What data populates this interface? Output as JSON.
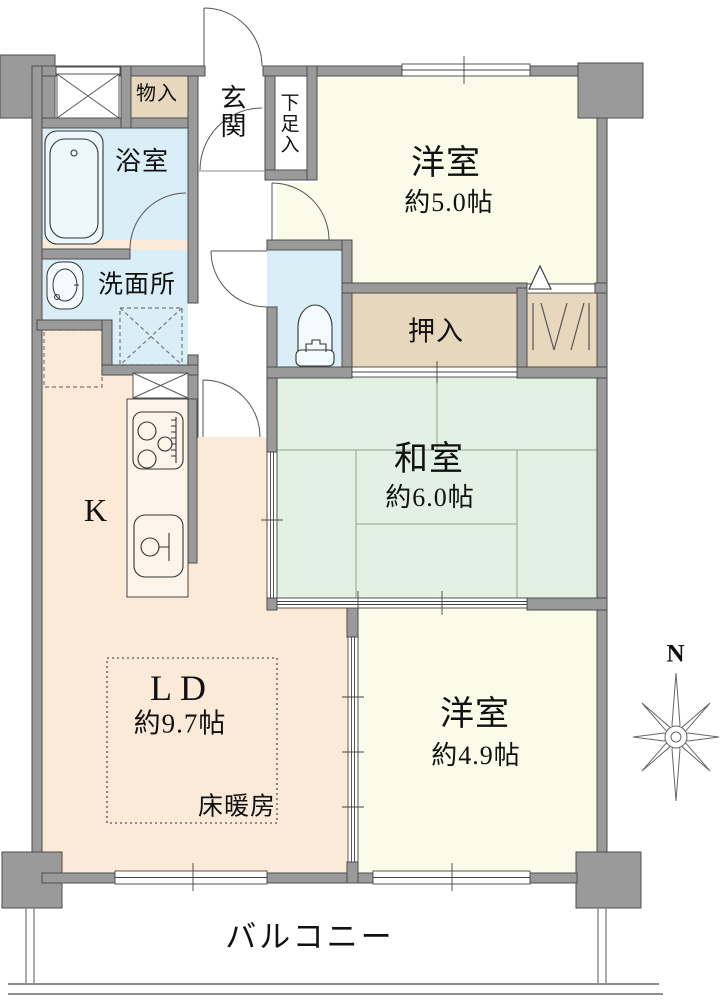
{
  "compass": {
    "north_label": "N"
  },
  "rooms": {
    "entrance": {
      "label": "玄関"
    },
    "shoe_cabinet": {
      "label": "下足入"
    },
    "storage": {
      "label": "物入"
    },
    "bathroom": {
      "label": "浴室"
    },
    "washroom": {
      "label": "洗面所"
    },
    "western_room_5": {
      "label": "洋室",
      "size": "約5.0帖"
    },
    "futon_closet": {
      "label": "押入"
    },
    "japanese_room": {
      "label": "和室",
      "size": "約6.0帖"
    },
    "kitchen": {
      "label": "K"
    },
    "living_dining": {
      "label": "LD",
      "size": "約9.7帖",
      "floor_heating_label": "床暖房"
    },
    "western_room_49": {
      "label": "洋室",
      "size": "約4.9帖"
    },
    "balcony": {
      "label": "バルコニー"
    }
  },
  "colors": {
    "wall": "#9a9a9a",
    "wet_area": "#d9eef6",
    "western_room": "#fafbe9",
    "japanese_room": "#e2f1e3",
    "ldk": "#fcead9",
    "closet": "#e6d7bd"
  }
}
